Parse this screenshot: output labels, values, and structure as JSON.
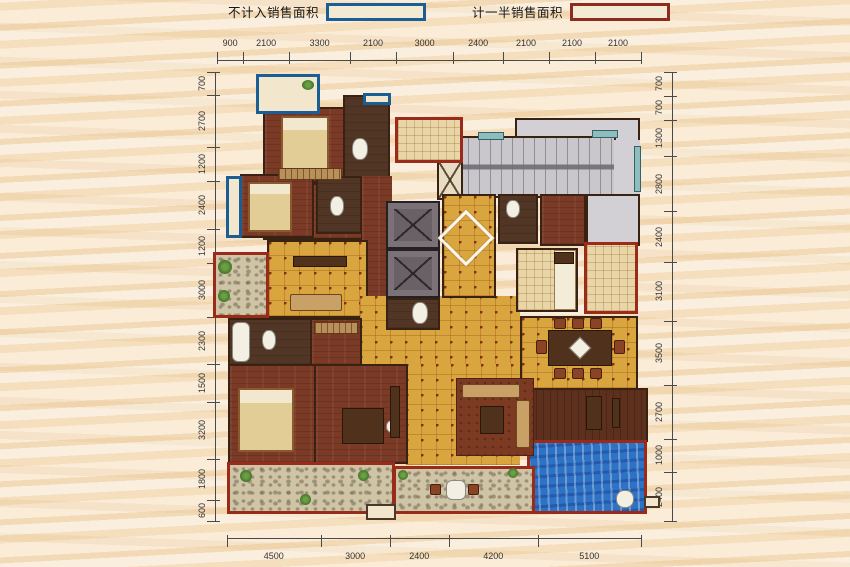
{
  "legend": {
    "items": [
      {
        "label": "不计入销售面积",
        "box_border": "#1b5e94"
      },
      {
        "label": "计一半销售面积",
        "box_border": "#8f2b1e"
      }
    ]
  },
  "dimensions": {
    "top": [
      "900",
      "2100",
      "3300",
      "2100",
      "3000",
      "2400",
      "2100",
      "2100",
      "2100"
    ],
    "bottom": [
      "4500",
      "3000",
      "2400",
      "4200",
      "5100"
    ],
    "left": [
      "700",
      "2700",
      "1200",
      "2400",
      "1200",
      "3000",
      "2300",
      "1500",
      "3200",
      "1800",
      "600"
    ],
    "right": [
      "700",
      "700",
      "1300",
      "2800",
      "2400",
      "3100",
      "3500",
      "2700",
      "1000",
      "2400"
    ]
  },
  "colors": {
    "background": "#f6e2c4",
    "accent_blue": "#1b5e94",
    "accent_red": "#9a2b1b",
    "tile_floor": "#d9a53f",
    "wood_floor": "#7b3a26",
    "pool_water": "#2e72c5",
    "stair_gray": "#c9c7cb"
  },
  "plan": {
    "items": [
      [
        "corridor-upper-gray",
        515,
        118,
        125,
        24,
        "gray wall"
      ],
      [
        "stairwell",
        444,
        136,
        172,
        62,
        "stair wall"
      ],
      [
        "stair-lobby",
        614,
        140,
        26,
        58,
        "gray"
      ],
      [
        "landing-room-right",
        586,
        194,
        54,
        52,
        "gray wall"
      ],
      [
        "shaft",
        437,
        160,
        26,
        40,
        "shaft"
      ],
      [
        "bedroom-north",
        263,
        107,
        82,
        76,
        "wood wall"
      ],
      [
        "bath-north",
        343,
        95,
        47,
        86,
        "bathdark wall"
      ],
      [
        "hall-north",
        263,
        183,
        100,
        57,
        "wood wall"
      ],
      [
        "corridor-west",
        362,
        176,
        30,
        122,
        "wood"
      ],
      [
        "bedroom-west",
        240,
        174,
        74,
        64,
        "wood wall"
      ],
      [
        "bath-west",
        316,
        176,
        46,
        58,
        "bathdark wall"
      ],
      [
        "family-room",
        267,
        240,
        101,
        78,
        "tile wall"
      ],
      [
        "living-room",
        360,
        296,
        160,
        70,
        "tile"
      ],
      [
        "living-room-south",
        406,
        364,
        114,
        101,
        "tile"
      ],
      [
        "elevator-1",
        386,
        201,
        54,
        48,
        "elev"
      ],
      [
        "elevator-2",
        386,
        249,
        54,
        49,
        "elev"
      ],
      [
        "entry-hall",
        442,
        194,
        54,
        104,
        "tile wall"
      ],
      [
        "entry-diamond",
        446,
        218,
        40,
        40,
        "diamond"
      ],
      [
        "bath-entry",
        386,
        298,
        54,
        32,
        "bathdark wall"
      ],
      [
        "bath-east",
        498,
        194,
        40,
        50,
        "bathdark wall"
      ],
      [
        "storage-room",
        540,
        194,
        46,
        52,
        "wood wall"
      ],
      [
        "kitchen",
        516,
        248,
        62,
        64,
        "tile-light wall"
      ],
      [
        "kitchen-counter",
        554,
        250,
        22,
        60,
        "counter"
      ],
      [
        "stove",
        554,
        252,
        20,
        12,
        "tdark"
      ],
      [
        "dining-room",
        520,
        316,
        118,
        74,
        "tile wall"
      ],
      [
        "deck-room",
        527,
        388,
        121,
        54,
        "wood2 wall"
      ],
      [
        "pool",
        527,
        440,
        120,
        74,
        "water red-b"
      ],
      [
        "master-bath",
        228,
        318,
        84,
        48,
        "bathdark wall"
      ],
      [
        "closet",
        310,
        318,
        52,
        48,
        "wood wall"
      ],
      [
        "master-bedroom",
        228,
        364,
        88,
        100,
        "wood wall"
      ],
      [
        "study",
        314,
        364,
        94,
        100,
        "wood wall"
      ],
      [
        "balcony-nw",
        256,
        74,
        64,
        40,
        "cream blue-b"
      ],
      [
        "window-balcony-west",
        226,
        176,
        16,
        62,
        "cream blue-b"
      ],
      [
        "window-north",
        363,
        93,
        28,
        12,
        "cream blue-b"
      ],
      [
        "equip-room-north",
        395,
        117,
        68,
        46,
        "tile-light red-b"
      ],
      [
        "garden-balcony-west",
        213,
        252,
        56,
        66,
        "stone red-b"
      ],
      [
        "service-balcony-east",
        584,
        242,
        54,
        72,
        "tile-light red-b"
      ],
      [
        "balcony-south-west",
        227,
        462,
        168,
        52,
        "stone red-b"
      ],
      [
        "balcony-south",
        393,
        466,
        142,
        48,
        "stone red-b"
      ],
      [
        "window-stair-top",
        478,
        132,
        26,
        8,
        "window"
      ],
      [
        "window-stair-top-2",
        592,
        130,
        26,
        8,
        "window"
      ],
      [
        "window-east",
        634,
        146,
        7,
        46,
        "window"
      ],
      [
        "bed-north",
        281,
        116,
        48,
        58,
        "bed"
      ],
      [
        "dresser-north",
        278,
        168,
        64,
        12,
        "wardrobe"
      ],
      [
        "bed-west",
        248,
        182,
        44,
        50,
        "bed"
      ],
      [
        "toilet-north",
        352,
        138,
        16,
        22,
        "fix"
      ],
      [
        "toilet-west",
        330,
        196,
        14,
        20,
        "fix"
      ],
      [
        "toilet-entry",
        412,
        302,
        16,
        22,
        "fix"
      ],
      [
        "toilet-east",
        506,
        200,
        14,
        18,
        "fix"
      ],
      [
        "tub-master",
        232,
        322,
        18,
        40,
        "fixr"
      ],
      [
        "toilet-master",
        262,
        330,
        14,
        20,
        "fix"
      ],
      [
        "closet-wardrobe",
        314,
        322,
        44,
        12,
        "wardrobe"
      ],
      [
        "family-table",
        293,
        256,
        54,
        11,
        "tdark"
      ],
      [
        "family-sofa",
        290,
        294,
        52,
        17,
        "sofa"
      ],
      [
        "master-bed",
        238,
        388,
        56,
        64,
        "bed"
      ],
      [
        "desk",
        342,
        408,
        42,
        36,
        "tdark"
      ],
      [
        "desk-chair",
        386,
        420,
        13,
        13,
        "fix"
      ],
      [
        "carpet",
        456,
        378,
        78,
        78,
        "carpet"
      ],
      [
        "sofa-main",
        462,
        384,
        58,
        14,
        "sofa"
      ],
      [
        "sofa-side",
        516,
        400,
        14,
        48,
        "sofa"
      ],
      [
        "coffee-table",
        480,
        406,
        24,
        28,
        "tdark"
      ],
      [
        "tv-cabinet",
        390,
        386,
        10,
        52,
        "tdark"
      ],
      [
        "dining-table",
        548,
        330,
        64,
        36,
        "tdark"
      ],
      [
        "dining-center",
        572,
        340,
        16,
        16,
        "diamond-small"
      ],
      [
        "chair",
        554,
        318,
        12,
        11,
        "chair"
      ],
      [
        "chair",
        572,
        318,
        12,
        11,
        "chair"
      ],
      [
        "chair",
        590,
        318,
        12,
        11,
        "chair"
      ],
      [
        "chair",
        554,
        368,
        12,
        11,
        "chair"
      ],
      [
        "chair",
        572,
        368,
        12,
        11,
        "chair"
      ],
      [
        "chair",
        590,
        368,
        12,
        11,
        "chair"
      ],
      [
        "chair",
        536,
        340,
        11,
        14,
        "chair"
      ],
      [
        "chair",
        614,
        340,
        11,
        14,
        "chair"
      ],
      [
        "shower-column",
        586,
        396,
        16,
        34,
        "tdark"
      ],
      [
        "shower-head",
        612,
        398,
        8,
        30,
        "tdark"
      ],
      [
        "pool-ladder",
        616,
        490,
        18,
        18,
        "fix"
      ],
      [
        "plant",
        302,
        80,
        12,
        10,
        "plant"
      ],
      [
        "plant",
        218,
        260,
        14,
        14,
        "plant"
      ],
      [
        "plant",
        218,
        290,
        12,
        12,
        "plant"
      ],
      [
        "plant",
        240,
        470,
        12,
        12,
        "plant"
      ],
      [
        "plant",
        300,
        494,
        11,
        11,
        "plant"
      ],
      [
        "plant",
        358,
        470,
        11,
        11,
        "plant"
      ],
      [
        "plant",
        398,
        470,
        10,
        10,
        "plant"
      ],
      [
        "plant",
        508,
        468,
        10,
        10,
        "plant"
      ],
      [
        "terrace-table",
        446,
        480,
        20,
        20,
        "fixr"
      ],
      [
        "terrace-chair",
        430,
        484,
        11,
        11,
        "chair"
      ],
      [
        "terrace-chair",
        468,
        484,
        11,
        11,
        "chair"
      ],
      [
        "entry-steps",
        366,
        504,
        30,
        16,
        "wall-thin"
      ],
      [
        "side-step",
        644,
        496,
        16,
        12,
        "wall-thin"
      ]
    ]
  }
}
